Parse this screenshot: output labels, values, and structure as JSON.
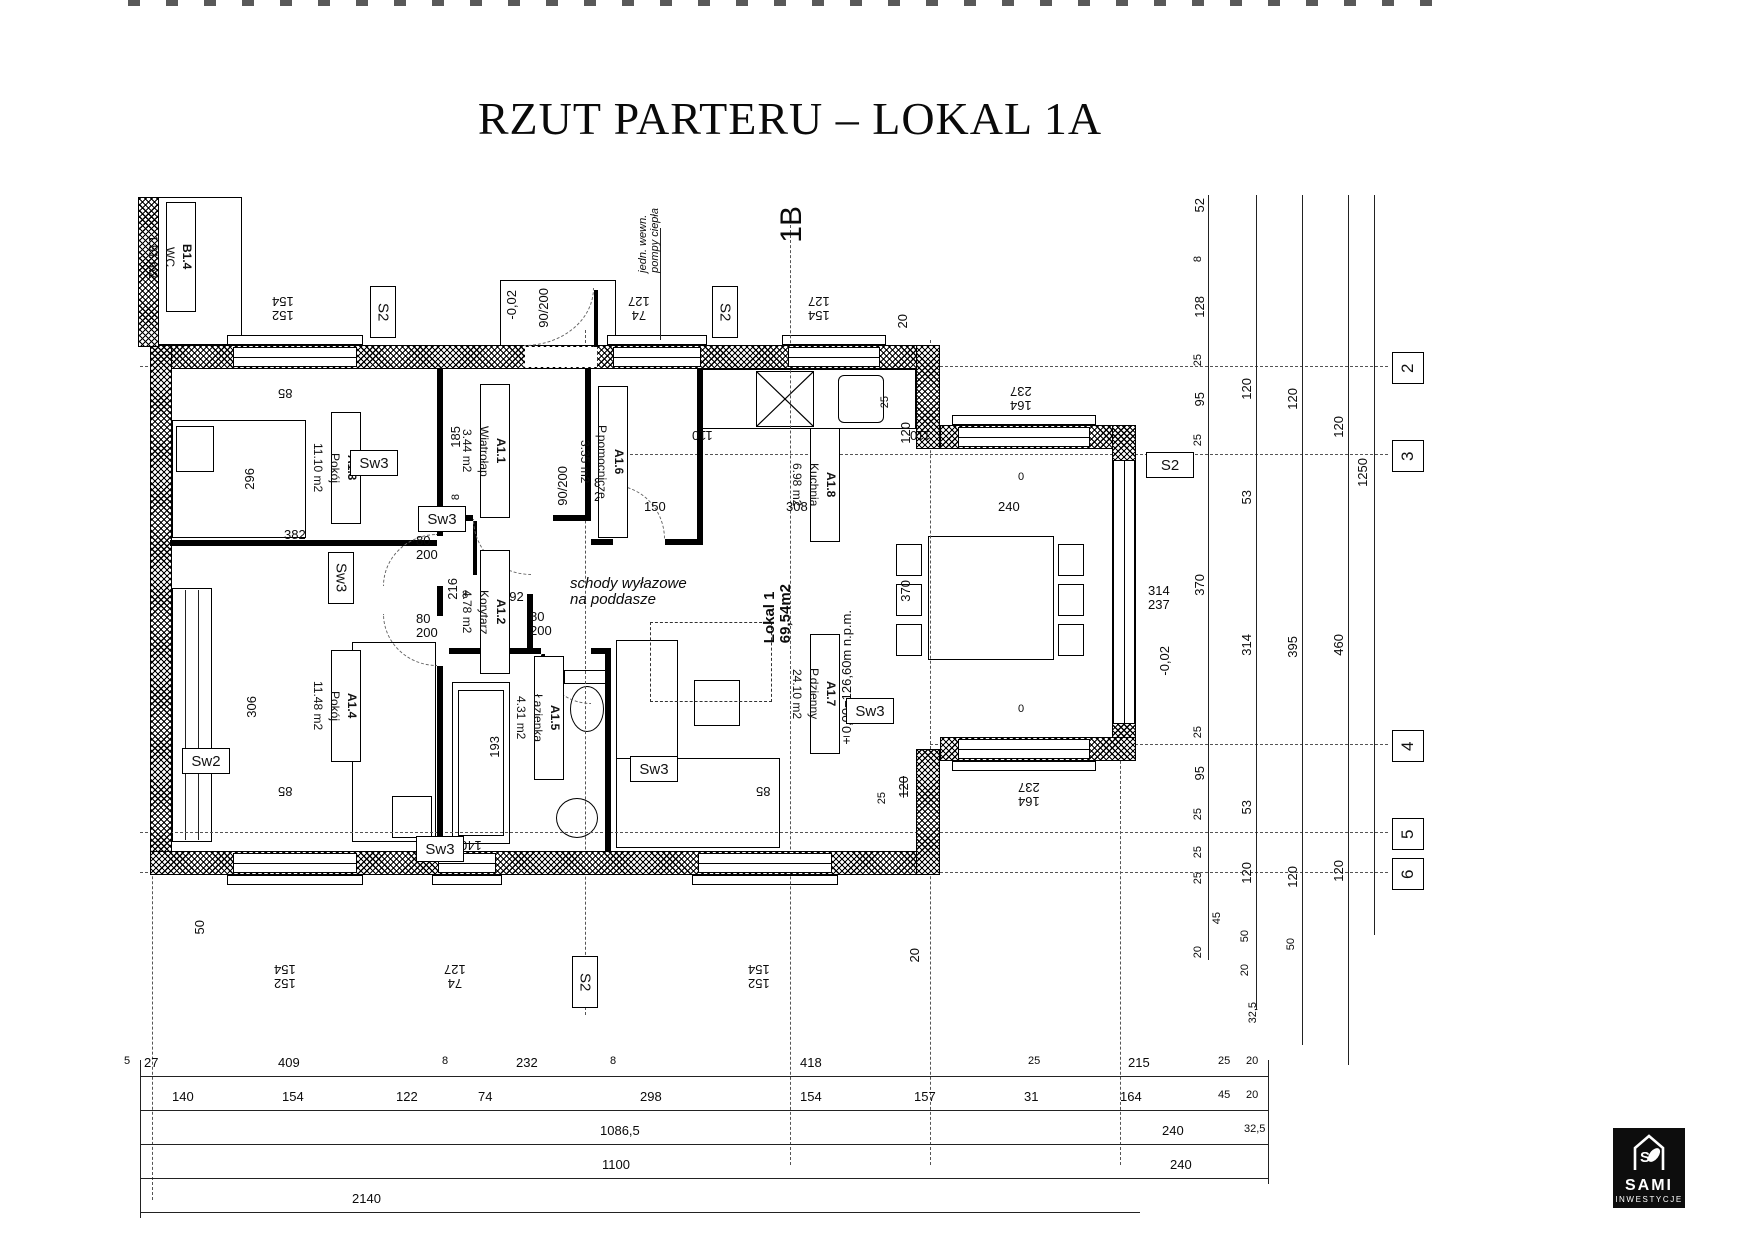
{
  "title": "RZUT PARTERU – LOKAL 1A",
  "logo": {
    "monogram": "S",
    "name": "SAMI",
    "sub": "INWESTYCJE"
  },
  "room_labels": [
    {
      "id": "B1.4",
      "name": "WC",
      "area": "1.91 m2",
      "x": 166,
      "y": 202,
      "h": 110
    },
    {
      "id": "A1.3",
      "name": "Pokój",
      "area": "11.10 m2",
      "x": 331,
      "y": 412,
      "h": 112
    },
    {
      "id": "A1.1",
      "name": "Wiatrołap",
      "area": "3.44 m2",
      "x": 480,
      "y": 384,
      "h": 134
    },
    {
      "id": "A1.6",
      "name": "P.pomocnicze",
      "area": "3.35 m2",
      "x": 598,
      "y": 386,
      "h": 152
    },
    {
      "id": "A1.8",
      "name": "Kuchnia",
      "area": "6.98 m2",
      "x": 810,
      "y": 428,
      "h": 114
    },
    {
      "id": "A1.2",
      "name": "Korytarz",
      "area": "4.78 m2",
      "x": 480,
      "y": 550,
      "h": 124
    },
    {
      "id": "A1.4",
      "name": "Pokój",
      "area": "11.48 m2",
      "x": 331,
      "y": 650,
      "h": 112
    },
    {
      "id": "A1.5",
      "name": "Łazienka",
      "area": "4.31 m2",
      "x": 534,
      "y": 656,
      "h": 124
    },
    {
      "id": "A1.7",
      "name": "P.dzienny",
      "area": "24.10 m2",
      "x": 810,
      "y": 634,
      "h": 120
    }
  ],
  "tag_boxes": [
    {
      "t": "S2",
      "x": 370,
      "y": 286,
      "cls": "v"
    },
    {
      "t": "S2",
      "x": 712,
      "y": 286,
      "cls": "v"
    },
    {
      "t": "S2",
      "x": 1146,
      "y": 452,
      "cls": "h"
    },
    {
      "t": "S2",
      "x": 572,
      "y": 956,
      "cls": "v"
    },
    {
      "t": "Sw3",
      "x": 350,
      "y": 450,
      "cls": "h"
    },
    {
      "t": "Sw3",
      "x": 328,
      "y": 552,
      "cls": "v"
    },
    {
      "t": "Sw3",
      "x": 418,
      "y": 506,
      "cls": "h"
    },
    {
      "t": "Sw3",
      "x": 416,
      "y": 836,
      "cls": "h"
    },
    {
      "t": "Sw3",
      "x": 630,
      "y": 756,
      "cls": "h"
    },
    {
      "t": "Sw3",
      "x": 846,
      "y": 698,
      "cls": "h"
    },
    {
      "t": "Sw2",
      "x": 182,
      "y": 748,
      "cls": "h"
    }
  ],
  "grid_bubbles": [
    {
      "t": "2",
      "y": 352
    },
    {
      "t": "3",
      "y": 440
    },
    {
      "t": "4",
      "y": 730
    },
    {
      "t": "5",
      "y": 818
    },
    {
      "t": "6",
      "y": 858
    }
  ],
  "dim_labels": [
    {
      "t": "152\n154",
      "x": 272,
      "y": 294,
      "cls": "r"
    },
    {
      "t": "-0,02",
      "x": 505,
      "y": 290,
      "cls": "v"
    },
    {
      "t": "90/200",
      "x": 537,
      "y": 288,
      "cls": "v"
    },
    {
      "t": "74\n127",
      "x": 628,
      "y": 294,
      "cls": "r"
    },
    {
      "t": "jedn. wewn.\npompy ciepła",
      "x": 638,
      "y": 208,
      "cls": "v i s"
    },
    {
      "t": "1B",
      "x": 776,
      "y": 206,
      "cls": "v xl"
    },
    {
      "t": "154\n127",
      "x": 808,
      "y": 294,
      "cls": "r"
    },
    {
      "t": "20",
      "x": 896,
      "y": 314,
      "cls": "v"
    },
    {
      "t": "85",
      "x": 278,
      "y": 386,
      "cls": "r"
    },
    {
      "t": "110",
      "x": 692,
      "y": 428,
      "cls": "r"
    },
    {
      "t": "110",
      "x": 910,
      "y": 428,
      "cls": "r"
    },
    {
      "t": "164\n237",
      "x": 1010,
      "y": 384,
      "cls": "r"
    },
    {
      "t": "25",
      "x": 880,
      "y": 396,
      "cls": "v s"
    },
    {
      "t": "120",
      "x": 899,
      "y": 422,
      "cls": "v"
    },
    {
      "t": "296",
      "x": 243,
      "y": 468,
      "cls": "v"
    },
    {
      "t": "185",
      "x": 449,
      "y": 426,
      "cls": "v"
    },
    {
      "t": "8",
      "x": 451,
      "y": 494,
      "cls": "v s"
    },
    {
      "t": "80\n200",
      "x": 594,
      "y": 476
    },
    {
      "t": "90/200",
      "x": 556,
      "y": 466,
      "cls": "v"
    },
    {
      "t": "150",
      "x": 644,
      "y": 500
    },
    {
      "t": "308",
      "x": 786,
      "y": 500
    },
    {
      "t": "240",
      "x": 998,
      "y": 500
    },
    {
      "t": "0",
      "x": 1018,
      "y": 472,
      "cls": "s"
    },
    {
      "t": "0",
      "x": 1018,
      "y": 704,
      "cls": "s"
    },
    {
      "t": "370",
      "x": 899,
      "y": 580,
      "cls": "v"
    },
    {
      "t": "382",
      "x": 284,
      "y": 528
    },
    {
      "t": "8",
      "x": 462,
      "y": 590,
      "cls": "s"
    },
    {
      "t": "192",
      "x": 502,
      "y": 590
    },
    {
      "t": "216",
      "x": 446,
      "y": 578,
      "cls": "v"
    },
    {
      "t": "80\n200",
      "x": 416,
      "y": 534
    },
    {
      "t": "80\n200",
      "x": 416,
      "y": 612
    },
    {
      "t": "80\n200",
      "x": 530,
      "y": 610
    },
    {
      "t": "schody wyłazowe\nna poddasze",
      "x": 570,
      "y": 576,
      "cls": "i md"
    },
    {
      "t": "Lokal 1\n69,54m2",
      "x": 762,
      "y": 584,
      "cls": "v lg"
    },
    {
      "t": "±0,00=126,60m n.p.m.",
      "x": 840,
      "y": 610,
      "cls": "v"
    },
    {
      "t": "306",
      "x": 245,
      "y": 696,
      "cls": "v"
    },
    {
      "t": "193",
      "x": 488,
      "y": 736,
      "cls": "v"
    },
    {
      "t": "140",
      "x": 460,
      "y": 838,
      "cls": "r"
    },
    {
      "t": "85",
      "x": 278,
      "y": 784,
      "cls": "r"
    },
    {
      "t": "85",
      "x": 756,
      "y": 784,
      "cls": "r"
    },
    {
      "t": "120",
      "x": 897,
      "y": 776,
      "cls": "v strike"
    },
    {
      "t": "25",
      "x": 877,
      "y": 792,
      "cls": "v s"
    },
    {
      "t": "164\n237",
      "x": 1018,
      "y": 780,
      "cls": "r"
    },
    {
      "t": "314\n237",
      "x": 1148,
      "y": 584
    },
    {
      "t": "-0,02",
      "x": 1158,
      "y": 646,
      "cls": "v"
    },
    {
      "t": "50",
      "x": 193,
      "y": 920,
      "cls": "v"
    },
    {
      "t": "20",
      "x": 908,
      "y": 948,
      "cls": "v"
    },
    {
      "t": "152\n154",
      "x": 274,
      "y": 962,
      "cls": "r"
    },
    {
      "t": "74\n127",
      "x": 444,
      "y": 962,
      "cls": "r"
    },
    {
      "t": "152\n154",
      "x": 748,
      "y": 962,
      "cls": "r"
    },
    {
      "t": "52",
      "x": 1193,
      "y": 198,
      "cls": "v"
    },
    {
      "t": "8",
      "x": 1193,
      "y": 256,
      "cls": "v s"
    },
    {
      "t": "128",
      "x": 1193,
      "y": 296,
      "cls": "v"
    },
    {
      "t": "25",
      "x": 1193,
      "y": 354,
      "cls": "v s"
    },
    {
      "t": "95",
      "x": 1193,
      "y": 392,
      "cls": "v"
    },
    {
      "t": "25",
      "x": 1193,
      "y": 434,
      "cls": "v s"
    },
    {
      "t": "370",
      "x": 1193,
      "y": 574,
      "cls": "v"
    },
    {
      "t": "25",
      "x": 1193,
      "y": 726,
      "cls": "v s"
    },
    {
      "t": "95",
      "x": 1193,
      "y": 766,
      "cls": "v"
    },
    {
      "t": "25",
      "x": 1193,
      "y": 808,
      "cls": "v s"
    },
    {
      "t": "25",
      "x": 1193,
      "y": 846,
      "cls": "v s"
    },
    {
      "t": "25",
      "x": 1193,
      "y": 872,
      "cls": "v s"
    },
    {
      "t": "20",
      "x": 1193,
      "y": 946,
      "cls": "v s"
    },
    {
      "t": "120",
      "x": 1240,
      "y": 378,
      "cls": "v"
    },
    {
      "t": "53",
      "x": 1240,
      "y": 490,
      "cls": "v"
    },
    {
      "t": "314",
      "x": 1240,
      "y": 634,
      "cls": "v"
    },
    {
      "t": "53",
      "x": 1240,
      "y": 800,
      "cls": "v"
    },
    {
      "t": "120",
      "x": 1240,
      "y": 862,
      "cls": "v"
    },
    {
      "t": "45",
      "x": 1212,
      "y": 912,
      "cls": "v s"
    },
    {
      "t": "50",
      "x": 1240,
      "y": 930,
      "cls": "v s"
    },
    {
      "t": "20",
      "x": 1240,
      "y": 964,
      "cls": "v s"
    },
    {
      "t": "120",
      "x": 1286,
      "y": 388,
      "cls": "v"
    },
    {
      "t": "395",
      "x": 1286,
      "y": 636,
      "cls": "v"
    },
    {
      "t": "120",
      "x": 1286,
      "y": 866,
      "cls": "v"
    },
    {
      "t": "50",
      "x": 1286,
      "y": 938,
      "cls": "v s"
    },
    {
      "t": "120",
      "x": 1332,
      "y": 416,
      "cls": "v"
    },
    {
      "t": "460",
      "x": 1332,
      "y": 634,
      "cls": "v"
    },
    {
      "t": "120",
      "x": 1332,
      "y": 860,
      "cls": "v"
    },
    {
      "t": "1250",
      "x": 1356,
      "y": 458,
      "cls": "v"
    },
    {
      "t": "32,5",
      "x": 1248,
      "y": 1002,
      "cls": "v s"
    },
    {
      "t": "5",
      "x": 124,
      "y": 1056,
      "cls": "s"
    },
    {
      "t": "27",
      "x": 144,
      "y": 1056
    },
    {
      "t": "409",
      "x": 278,
      "y": 1056
    },
    {
      "t": "8",
      "x": 442,
      "y": 1056,
      "cls": "s"
    },
    {
      "t": "232",
      "x": 516,
      "y": 1056
    },
    {
      "t": "8",
      "x": 610,
      "y": 1056,
      "cls": "s"
    },
    {
      "t": "418",
      "x": 800,
      "y": 1056
    },
    {
      "t": "25",
      "x": 1028,
      "y": 1056,
      "cls": "s"
    },
    {
      "t": "215",
      "x": 1128,
      "y": 1056
    },
    {
      "t": "25",
      "x": 1218,
      "y": 1056,
      "cls": "s"
    },
    {
      "t": "20",
      "x": 1246,
      "y": 1056,
      "cls": "s"
    },
    {
      "t": "140",
      "x": 172,
      "y": 1090
    },
    {
      "t": "154",
      "x": 282,
      "y": 1090
    },
    {
      "t": "122",
      "x": 396,
      "y": 1090
    },
    {
      "t": "74",
      "x": 478,
      "y": 1090
    },
    {
      "t": "298",
      "x": 640,
      "y": 1090
    },
    {
      "t": "154",
      "x": 800,
      "y": 1090
    },
    {
      "t": "157",
      "x": 914,
      "y": 1090
    },
    {
      "t": "31",
      "x": 1024,
      "y": 1090
    },
    {
      "t": "164",
      "x": 1120,
      "y": 1090
    },
    {
      "t": "45",
      "x": 1218,
      "y": 1090,
      "cls": "s"
    },
    {
      "t": "20",
      "x": 1246,
      "y": 1090,
      "cls": "s"
    },
    {
      "t": "1086,5",
      "x": 600,
      "y": 1124
    },
    {
      "t": "240",
      "x": 1162,
      "y": 1124
    },
    {
      "t": "32,5",
      "x": 1244,
      "y": 1124,
      "cls": "s"
    },
    {
      "t": "1100",
      "x": 602,
      "y": 1158
    },
    {
      "t": "240",
      "x": 1170,
      "y": 1158
    },
    {
      "t": "2140",
      "x": 352,
      "y": 1192
    }
  ]
}
